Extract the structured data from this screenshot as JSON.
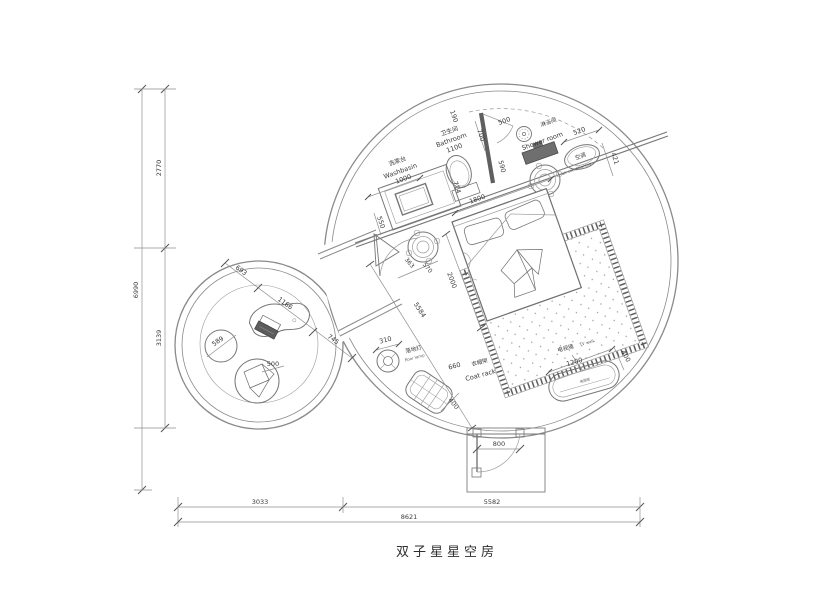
{
  "title": "双子星星空房",
  "rooms": {
    "washbasin": {
      "cn": "洗漱台",
      "en": "Washbasin",
      "dim": "1000"
    },
    "bathroom": {
      "cn": "卫生间",
      "en": "Bathroom",
      "dim": "1100"
    },
    "shower": {
      "cn": "淋浴间",
      "en": "Shower room"
    },
    "ac": {
      "cn": "空调",
      "en": "air conditioning"
    },
    "lamp": {
      "cn": "落地灯",
      "en": "floor lamp",
      "dim": "310"
    },
    "rack": {
      "cn": "衣帽架",
      "en": "Coat rack",
      "dim": "660",
      "len": "400"
    },
    "tv": {
      "cn": "电视墙",
      "en": "TV wall",
      "len": "1200",
      "depth": "400",
      "cabinet": "电视柜"
    }
  },
  "dims": {
    "overall_h": "6990",
    "h_top": "2770",
    "h_bottom": "3139",
    "w_left": "3033",
    "w_right": "5582",
    "overall_w": "8621",
    "door": "800",
    "bed_w": "1800",
    "bed_l": "2000",
    "diag": "5584",
    "d190": "190",
    "d700": "700",
    "d500": "500",
    "d520": "520",
    "d421": "421",
    "d590": "590",
    "d714": "714",
    "d550": "550",
    "ns1": "363",
    "ns2": "570",
    "t693": "693",
    "t1166": "1166",
    "t745": "745",
    "stool": "589",
    "bag": "500"
  }
}
